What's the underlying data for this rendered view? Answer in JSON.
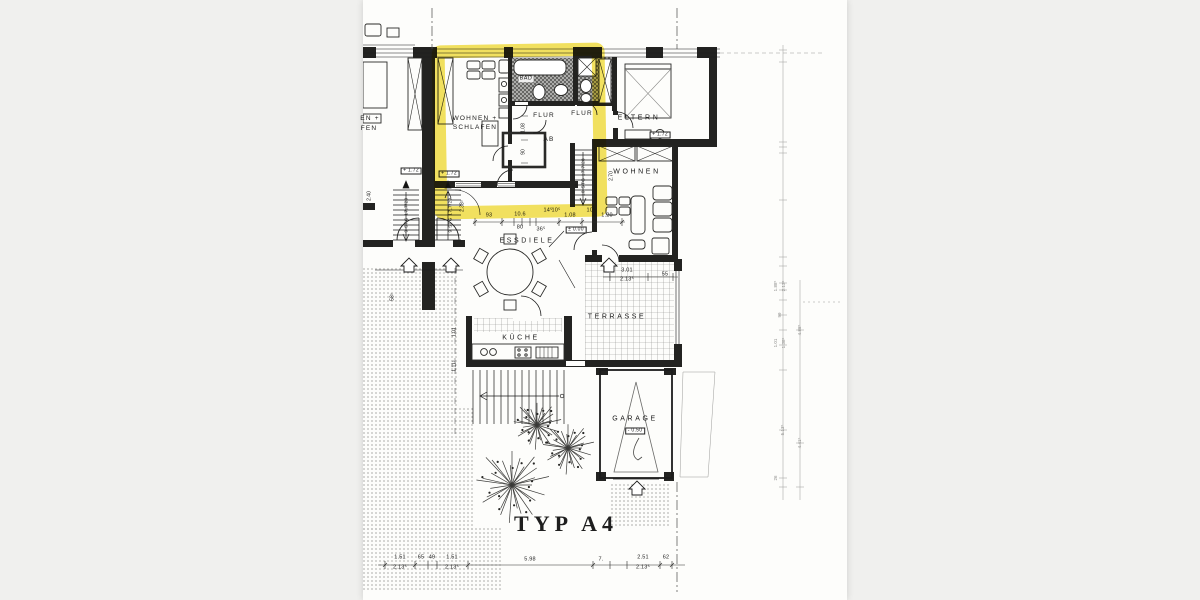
{
  "document": {
    "kind": "scanned floor plan",
    "plan_title": "TYP A4"
  },
  "colors": {
    "background": "#f0f0ee",
    "paper": "#fdfdfb",
    "ink": "#1c1c1c",
    "highlight_marker": "#f2df52"
  },
  "annotations": [
    {
      "n": "room-label-wohnen-schlafen-1",
      "t": "WOHNEN +",
      "x": 112,
      "y": 119,
      "c": "room"
    },
    {
      "n": "room-label-wohnen-schlafen-2",
      "t": "SCHLAFEN",
      "x": 112,
      "y": 128,
      "c": "room"
    },
    {
      "n": "room-label-bad",
      "t": "BAD",
      "x": 163,
      "y": 79,
      "c": "chip"
    },
    {
      "n": "room-label-flur-studio",
      "t": "FLUR",
      "x": 181,
      "y": 116,
      "c": "room"
    },
    {
      "n": "room-label-ab",
      "t": "AB",
      "x": 186,
      "y": 140,
      "c": "room"
    },
    {
      "n": "room-label-flur-right",
      "t": "FLUR",
      "x": 219,
      "y": 114,
      "c": "room"
    },
    {
      "n": "room-label-eltern",
      "t": "ELTERN",
      "x": 276,
      "y": 118,
      "c": "rooms"
    },
    {
      "n": "room-label-wohnen-right",
      "t": "WOHNEN",
      "x": 274,
      "y": 172,
      "c": "rooms"
    },
    {
      "n": "room-label-essdiele",
      "t": "ESSDIELE",
      "x": 164,
      "y": 241,
      "c": "rooms"
    },
    {
      "n": "room-label-kueche",
      "t": "KÜCHE",
      "x": 158,
      "y": 338,
      "c": "rooms"
    },
    {
      "n": "room-label-terrasse",
      "t": "TERRASSE",
      "x": 254,
      "y": 317,
      "c": "rooms"
    },
    {
      "n": "room-label-garage",
      "t": "GARAGE",
      "x": 272,
      "y": 419,
      "c": "rooms"
    },
    {
      "n": "plan-title",
      "t": "TYP A4",
      "x": 203,
      "y": 524,
      "c": "stencil"
    },
    {
      "n": "cut-label-neighbor-1",
      "t": "EN +",
      "x": 7,
      "y": 119,
      "c": "room"
    },
    {
      "n": "cut-label-neighbor-2",
      "t": "FEN",
      "x": 6,
      "y": 129,
      "c": "room"
    },
    {
      "n": "level-marker",
      "t": "+ 1.72",
      "x": 48,
      "y": 171,
      "c": "lvl"
    },
    {
      "n": "level-marker",
      "t": "+ 1.72",
      "x": 86,
      "y": 174,
      "c": "lvl"
    },
    {
      "n": "level-marker",
      "t": "+ 1.72",
      "x": 297,
      "y": 135,
      "c": "lvl"
    },
    {
      "n": "level-marker",
      "t": "± 0.00",
      "x": 213,
      "y": 230,
      "c": "lvl"
    },
    {
      "n": "level-marker",
      "t": "- 0.50",
      "x": 272,
      "y": 431,
      "c": "lvl"
    },
    {
      "n": "stair-note",
      "t": "9 STG 17,7/29",
      "x": 44,
      "y": 215,
      "c": "stgv"
    },
    {
      "n": "stair-note",
      "t": "9 STG 17,7/29",
      "x": 88,
      "y": 215,
      "c": "stgv"
    },
    {
      "n": "stair-note",
      "t": "10 STG 17,7/28",
      "x": 221,
      "y": 177,
      "c": "stgv"
    },
    {
      "n": "dim",
      "t": "93",
      "x": 126,
      "y": 216,
      "c": "dim"
    },
    {
      "n": "dim",
      "t": "10.6",
      "x": 157,
      "y": 215,
      "c": "dim"
    },
    {
      "n": "dim",
      "t": "80",
      "x": 157,
      "y": 228,
      "c": "dim"
    },
    {
      "n": "dim",
      "t": "36⁵",
      "x": 178,
      "y": 230,
      "c": "dim"
    },
    {
      "n": "dim",
      "t": "14⁵",
      "x": 185,
      "y": 211,
      "c": "dim"
    },
    {
      "n": "dim",
      "t": "10⁵",
      "x": 193,
      "y": 211,
      "c": "dim"
    },
    {
      "n": "dim",
      "t": "1.08",
      "x": 207,
      "y": 216,
      "c": "dim"
    },
    {
      "n": "dim",
      "t": "10⁵",
      "x": 228,
      "y": 211,
      "c": "dim"
    },
    {
      "n": "dim",
      "t": "1.20",
      "x": 244,
      "y": 216,
      "c": "dim"
    },
    {
      "n": "dim",
      "t": "3.01",
      "x": 264,
      "y": 271,
      "c": "dim"
    },
    {
      "n": "dim",
      "t": "2.13⁵",
      "x": 264,
      "y": 280,
      "c": "dim"
    },
    {
      "n": "dim",
      "t": "55",
      "x": 302,
      "y": 275,
      "c": "dim"
    },
    {
      "n": "dim",
      "t": "2.40",
      "x": 7,
      "y": 196,
      "c": "dimv"
    },
    {
      "n": "dim",
      "t": "2.38⁵",
      "x": 100,
      "y": 206,
      "c": "dimv"
    },
    {
      "n": "dim",
      "t": "2.70",
      "x": 249,
      "y": 176,
      "c": "dimv"
    },
    {
      "n": "dim",
      "t": "1.01",
      "x": 92,
      "y": 332,
      "c": "dimv"
    },
    {
      "n": "dim",
      "t": "1.11⁵",
      "x": 92,
      "y": 366,
      "c": "dimv"
    },
    {
      "n": "dim",
      "t": "58⁵",
      "x": 30,
      "y": 297,
      "c": "dimv"
    },
    {
      "n": "dim",
      "t": "1.08",
      "x": 161,
      "y": 128,
      "c": "dimv"
    },
    {
      "n": "dim",
      "t": "90",
      "x": 161,
      "y": 152,
      "c": "dimv"
    },
    {
      "n": "dim",
      "t": "1.51",
      "x": 37,
      "y": 558,
      "c": "dim"
    },
    {
      "n": "dim",
      "t": "2.13⁵",
      "x": 37,
      "y": 568,
      "c": "dim"
    },
    {
      "n": "dim",
      "t": "65",
      "x": 58,
      "y": 558,
      "c": "dim"
    },
    {
      "n": "dim",
      "t": "49",
      "x": 69,
      "y": 558,
      "c": "dim"
    },
    {
      "n": "dim",
      "t": "1.51",
      "x": 89,
      "y": 558,
      "c": "dim"
    },
    {
      "n": "dim",
      "t": "2.13⁵",
      "x": 89,
      "y": 568,
      "c": "dim"
    },
    {
      "n": "dim",
      "t": "5.98",
      "x": 167,
      "y": 560,
      "c": "dim"
    },
    {
      "n": "dim",
      "t": "7.",
      "x": 238,
      "y": 560,
      "c": "dim"
    },
    {
      "n": "dim",
      "t": "2.51",
      "x": 280,
      "y": 558,
      "c": "dim"
    },
    {
      "n": "dim",
      "t": "2.13⁵",
      "x": 280,
      "y": 568,
      "c": "dim"
    },
    {
      "n": "dim",
      "t": "62",
      "x": 303,
      "y": 558,
      "c": "dim"
    },
    {
      "n": "dim-faint",
      "t": "1.88⁵",
      "x": 413,
      "y": 286,
      "c": "faint"
    },
    {
      "n": "dim-faint",
      "t": "2.13⁵",
      "x": 421,
      "y": 286,
      "c": "faint"
    },
    {
      "n": "dim-faint",
      "t": "99",
      "x": 417,
      "y": 315,
      "c": "faint"
    },
    {
      "n": "dim-faint",
      "t": "1.01",
      "x": 413,
      "y": 343,
      "c": "faint"
    },
    {
      "n": "dim-faint",
      "t": "1.38⁵",
      "x": 421,
      "y": 343,
      "c": "faint"
    },
    {
      "n": "dim-faint",
      "t": "4.88⁵",
      "x": 437,
      "y": 330,
      "c": "faint"
    },
    {
      "n": "dim-faint",
      "t": "5.13⁵",
      "x": 420,
      "y": 430,
      "c": "faint"
    },
    {
      "n": "dim-faint",
      "t": "4.41⁵",
      "x": 437,
      "y": 443,
      "c": "faint"
    },
    {
      "n": "dim-faint",
      "t": "26",
      "x": 413,
      "y": 478,
      "c": "faint"
    }
  ]
}
